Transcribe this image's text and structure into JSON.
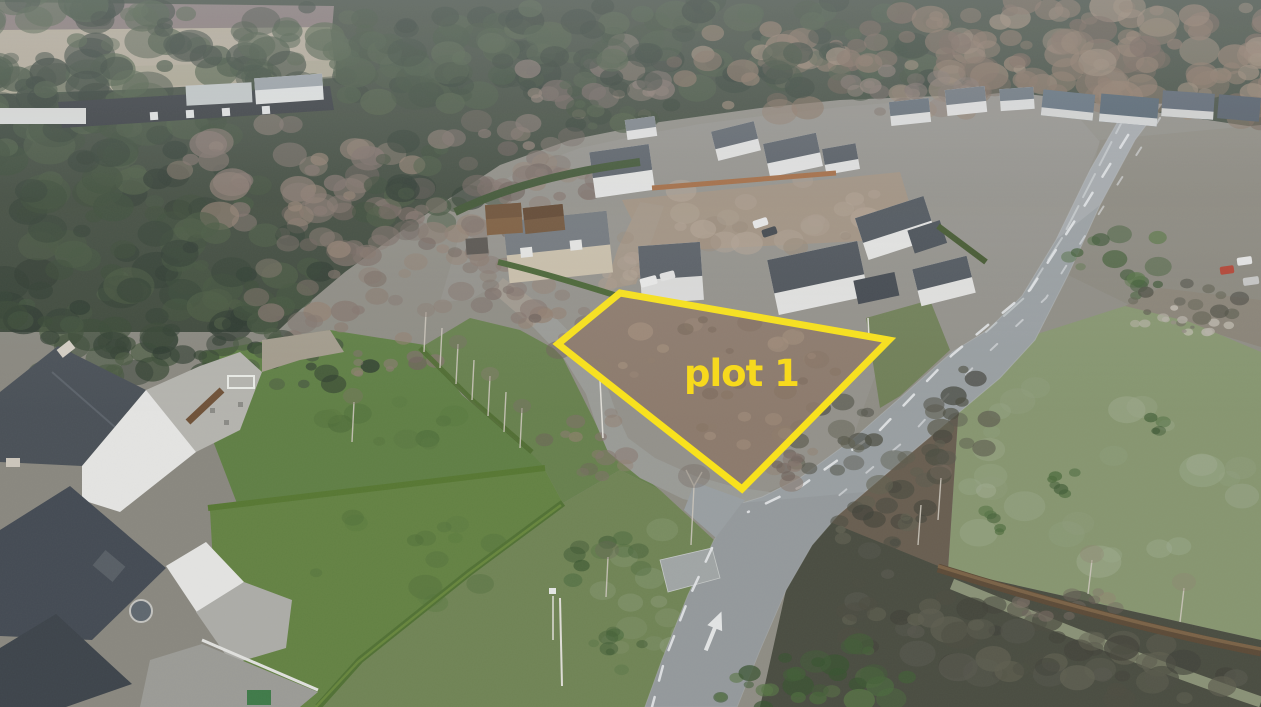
{
  "annotation": {
    "plot_label": "plot 1",
    "outline_color": "#ffe713",
    "label_color": "#ffdf10"
  },
  "palette": {
    "road_asphalt": "#9aa0a2",
    "plot_soil": "#8d7a6a",
    "conifer_forest": "#3b4637",
    "lawn_green": "#5e7f41",
    "pasture_green": "#87976e",
    "pale_field": "#b7ad97"
  }
}
